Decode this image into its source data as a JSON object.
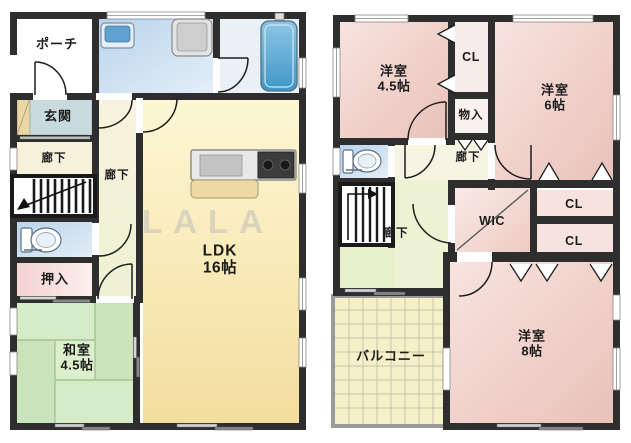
{
  "watermark": "LALA",
  "floor1": {
    "rooms": {
      "porch": {
        "label": "ポーチ"
      },
      "entrance": {
        "label": "玄関"
      },
      "hallway_a": {
        "label": "廊下"
      },
      "hallway_b": {
        "label": "廊下"
      },
      "oshiire": {
        "label": "押入"
      },
      "washitsu": {
        "label": "和室",
        "size": "4.5帖"
      },
      "ldk": {
        "label": "LDK",
        "size": "16帖"
      }
    }
  },
  "floor2": {
    "rooms": {
      "bedroom_45": {
        "label": "洋室",
        "size": "4.5帖"
      },
      "closet_top": {
        "label": "CL"
      },
      "bedroom_6": {
        "label": "洋室",
        "size": "6帖"
      },
      "storage": {
        "label": "物入"
      },
      "hallway_a": {
        "label": "廊下"
      },
      "hallway_b": {
        "label": "廊下"
      },
      "wic": {
        "label": "WIC"
      },
      "closet_a": {
        "label": "CL"
      },
      "closet_b": {
        "label": "CL"
      },
      "bedroom_8": {
        "label": "洋室",
        "size": "8帖"
      },
      "balcony": {
        "label": "バルコニー"
      }
    }
  },
  "colors": {
    "wall": "#2e2e2e",
    "room_pink": "#eec6be",
    "room_yellow": "#f6e1a4",
    "tatami_green": "#d2e8c2",
    "water_blue": "#c3daee",
    "corridor_cream": "#f6f1da",
    "corridor_green": "#ecf2d4",
    "balcony_tile": "#f6f0c8",
    "tub_blue": "#4a9cc8"
  }
}
